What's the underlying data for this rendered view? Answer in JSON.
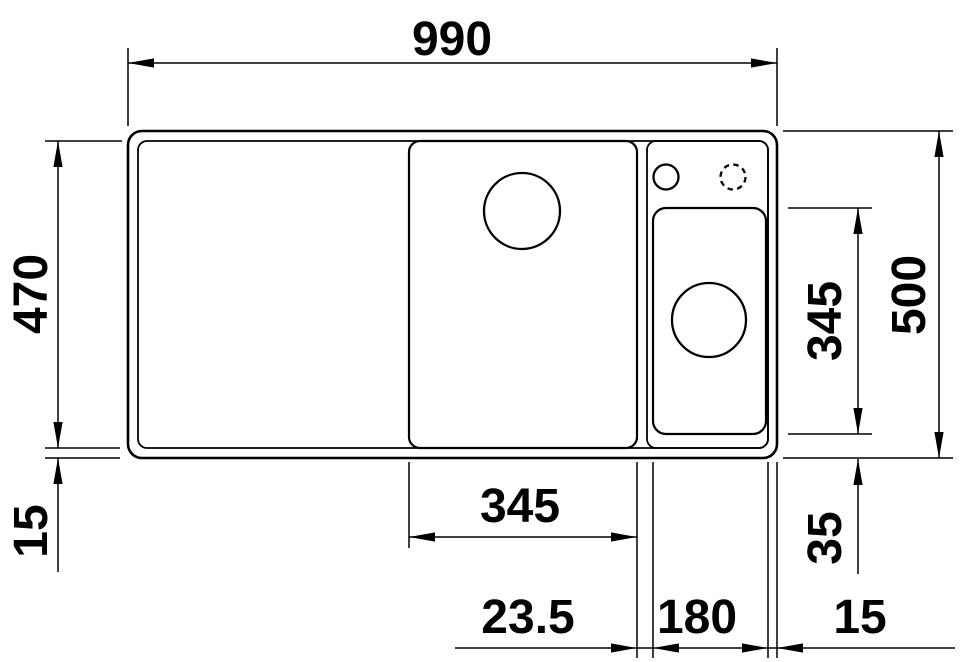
{
  "page": {
    "background_color": "#ffffff",
    "line_color": "#000000",
    "text_color": "#000000"
  },
  "drawing": {
    "type": "technical-drawing",
    "subject": "kitchen sink top view with dimensions",
    "canvas": {
      "w": 960,
      "h": 662
    },
    "parts": {
      "sink_outer_edge": {
        "x": 128,
        "y": 131,
        "w": 649,
        "h": 327,
        "rx": 14,
        "sw": 2.6
      },
      "sink_rim_inner_edge": {
        "x": 138,
        "y": 141,
        "w": 630,
        "h": 307,
        "rx": 9,
        "sw": 1.8
      },
      "main_bowl": {
        "x": 409,
        "y": 141,
        "w": 228,
        "h": 307,
        "rx": 11,
        "sw": 2.2
      },
      "right_compartment": {
        "x": 647,
        "y": 141,
        "w": 121,
        "h": 307,
        "rx": 9,
        "sw": 1.8
      },
      "accessory_bowl": {
        "x": 653,
        "y": 208,
        "w": 113,
        "h": 226,
        "rx": 13,
        "sw": 2.2
      },
      "main_bowl_drain_hole": {
        "cx": 522,
        "cy": 211,
        "r": 38,
        "sw": 2.3
      },
      "accessory_bowl_drain_hole": {
        "cx": 709,
        "cy": 320,
        "r": 37,
        "sw": 2.3
      },
      "tap_hole": {
        "cx": 666,
        "cy": 177,
        "r": 12.5,
        "sw": 2.3
      },
      "tap_hole_optional": {
        "cx": 733,
        "cy": 177,
        "r": 12.5,
        "sw": 2.3,
        "dash": "5.5 4.3"
      }
    },
    "dimensions": [
      {
        "id": "overall-width",
        "label": "990",
        "lx": 452,
        "ly": 38,
        "rot": 0,
        "lines": [
          [
            128,
            48,
            128,
            126
          ],
          [
            777,
            48,
            777,
            126
          ],
          [
            128,
            63,
            777,
            63
          ]
        ],
        "arrows": [
          [
            128,
            63,
            "left"
          ],
          [
            777,
            63,
            "right"
          ]
        ]
      },
      {
        "id": "inner-depth",
        "label": "470",
        "lx": 30,
        "ly": 294,
        "rot": -90,
        "lines": [
          [
            45,
            141,
            122,
            141
          ],
          [
            45,
            448,
            120,
            448
          ],
          [
            58,
            141,
            58,
            448
          ]
        ],
        "arrows": [
          [
            58,
            141,
            "up"
          ],
          [
            58,
            448,
            "down"
          ]
        ]
      },
      {
        "id": "front-rim-width",
        "label": "15",
        "lx": 30,
        "ly": 531,
        "rot": -90,
        "lines": [
          [
            45,
            458,
            120,
            458
          ],
          [
            58,
            458,
            58,
            572
          ]
        ],
        "arrows": [
          [
            58,
            458,
            "up"
          ]
        ]
      },
      {
        "id": "overall-depth",
        "label": "500",
        "lx": 908,
        "ly": 295,
        "rot": -90,
        "lines": [
          [
            783,
            131,
            953,
            131
          ],
          [
            783,
            458,
            953,
            458
          ],
          [
            939,
            131,
            939,
            458
          ]
        ],
        "arrows": [
          [
            939,
            131,
            "up"
          ],
          [
            939,
            458,
            "down"
          ]
        ]
      },
      {
        "id": "accessory-bowl-depth",
        "label": "345",
        "lx": 824,
        "ly": 321,
        "rot": -90,
        "lines": [
          [
            788,
            208,
            872,
            208
          ],
          [
            788,
            434,
            872,
            434
          ],
          [
            858,
            208,
            858,
            434
          ]
        ],
        "arrows": [
          [
            858,
            208,
            "up"
          ],
          [
            858,
            434,
            "down"
          ]
        ]
      },
      {
        "id": "accessory-bowl-front-offset",
        "label": "35",
        "lx": 824,
        "ly": 538,
        "rot": -90,
        "lines": [
          [
            858,
            459,
            858,
            574
          ]
        ],
        "arrows": [
          [
            858,
            459,
            "up"
          ]
        ]
      },
      {
        "id": "main-bowl-width",
        "label": "345",
        "lx": 520,
        "ly": 505,
        "rot": 0,
        "lines": [
          [
            409,
            462,
            409,
            548
          ],
          [
            409,
            537,
            637,
            537
          ]
        ],
        "arrows": [
          [
            409,
            537,
            "left"
          ],
          [
            637,
            537,
            "right"
          ]
        ]
      },
      {
        "id": "bowl-divider-width",
        "label": "23.5",
        "lx": 528,
        "ly": 616,
        "rot": 0,
        "lines": [
          [
            637,
            462,
            637,
            658
          ],
          [
            653,
            462,
            653,
            658
          ],
          [
            455,
            648,
            955,
            648
          ]
        ],
        "arrows": [
          [
            637,
            648,
            "right"
          ],
          [
            653,
            648,
            "left"
          ]
        ]
      },
      {
        "id": "accessory-bowl-width",
        "label": "180",
        "lx": 697,
        "ly": 616,
        "rot": 0,
        "lines": [
          [
            768,
            462,
            768,
            658
          ]
        ],
        "arrows": [
          [
            768,
            648,
            "right"
          ]
        ]
      },
      {
        "id": "right-rim-width",
        "label": "15",
        "lx": 860,
        "ly": 616,
        "rot": 0,
        "lines": [
          [
            777,
            462,
            777,
            658
          ]
        ],
        "arrows": [
          [
            777,
            648,
            "left"
          ]
        ]
      }
    ]
  }
}
